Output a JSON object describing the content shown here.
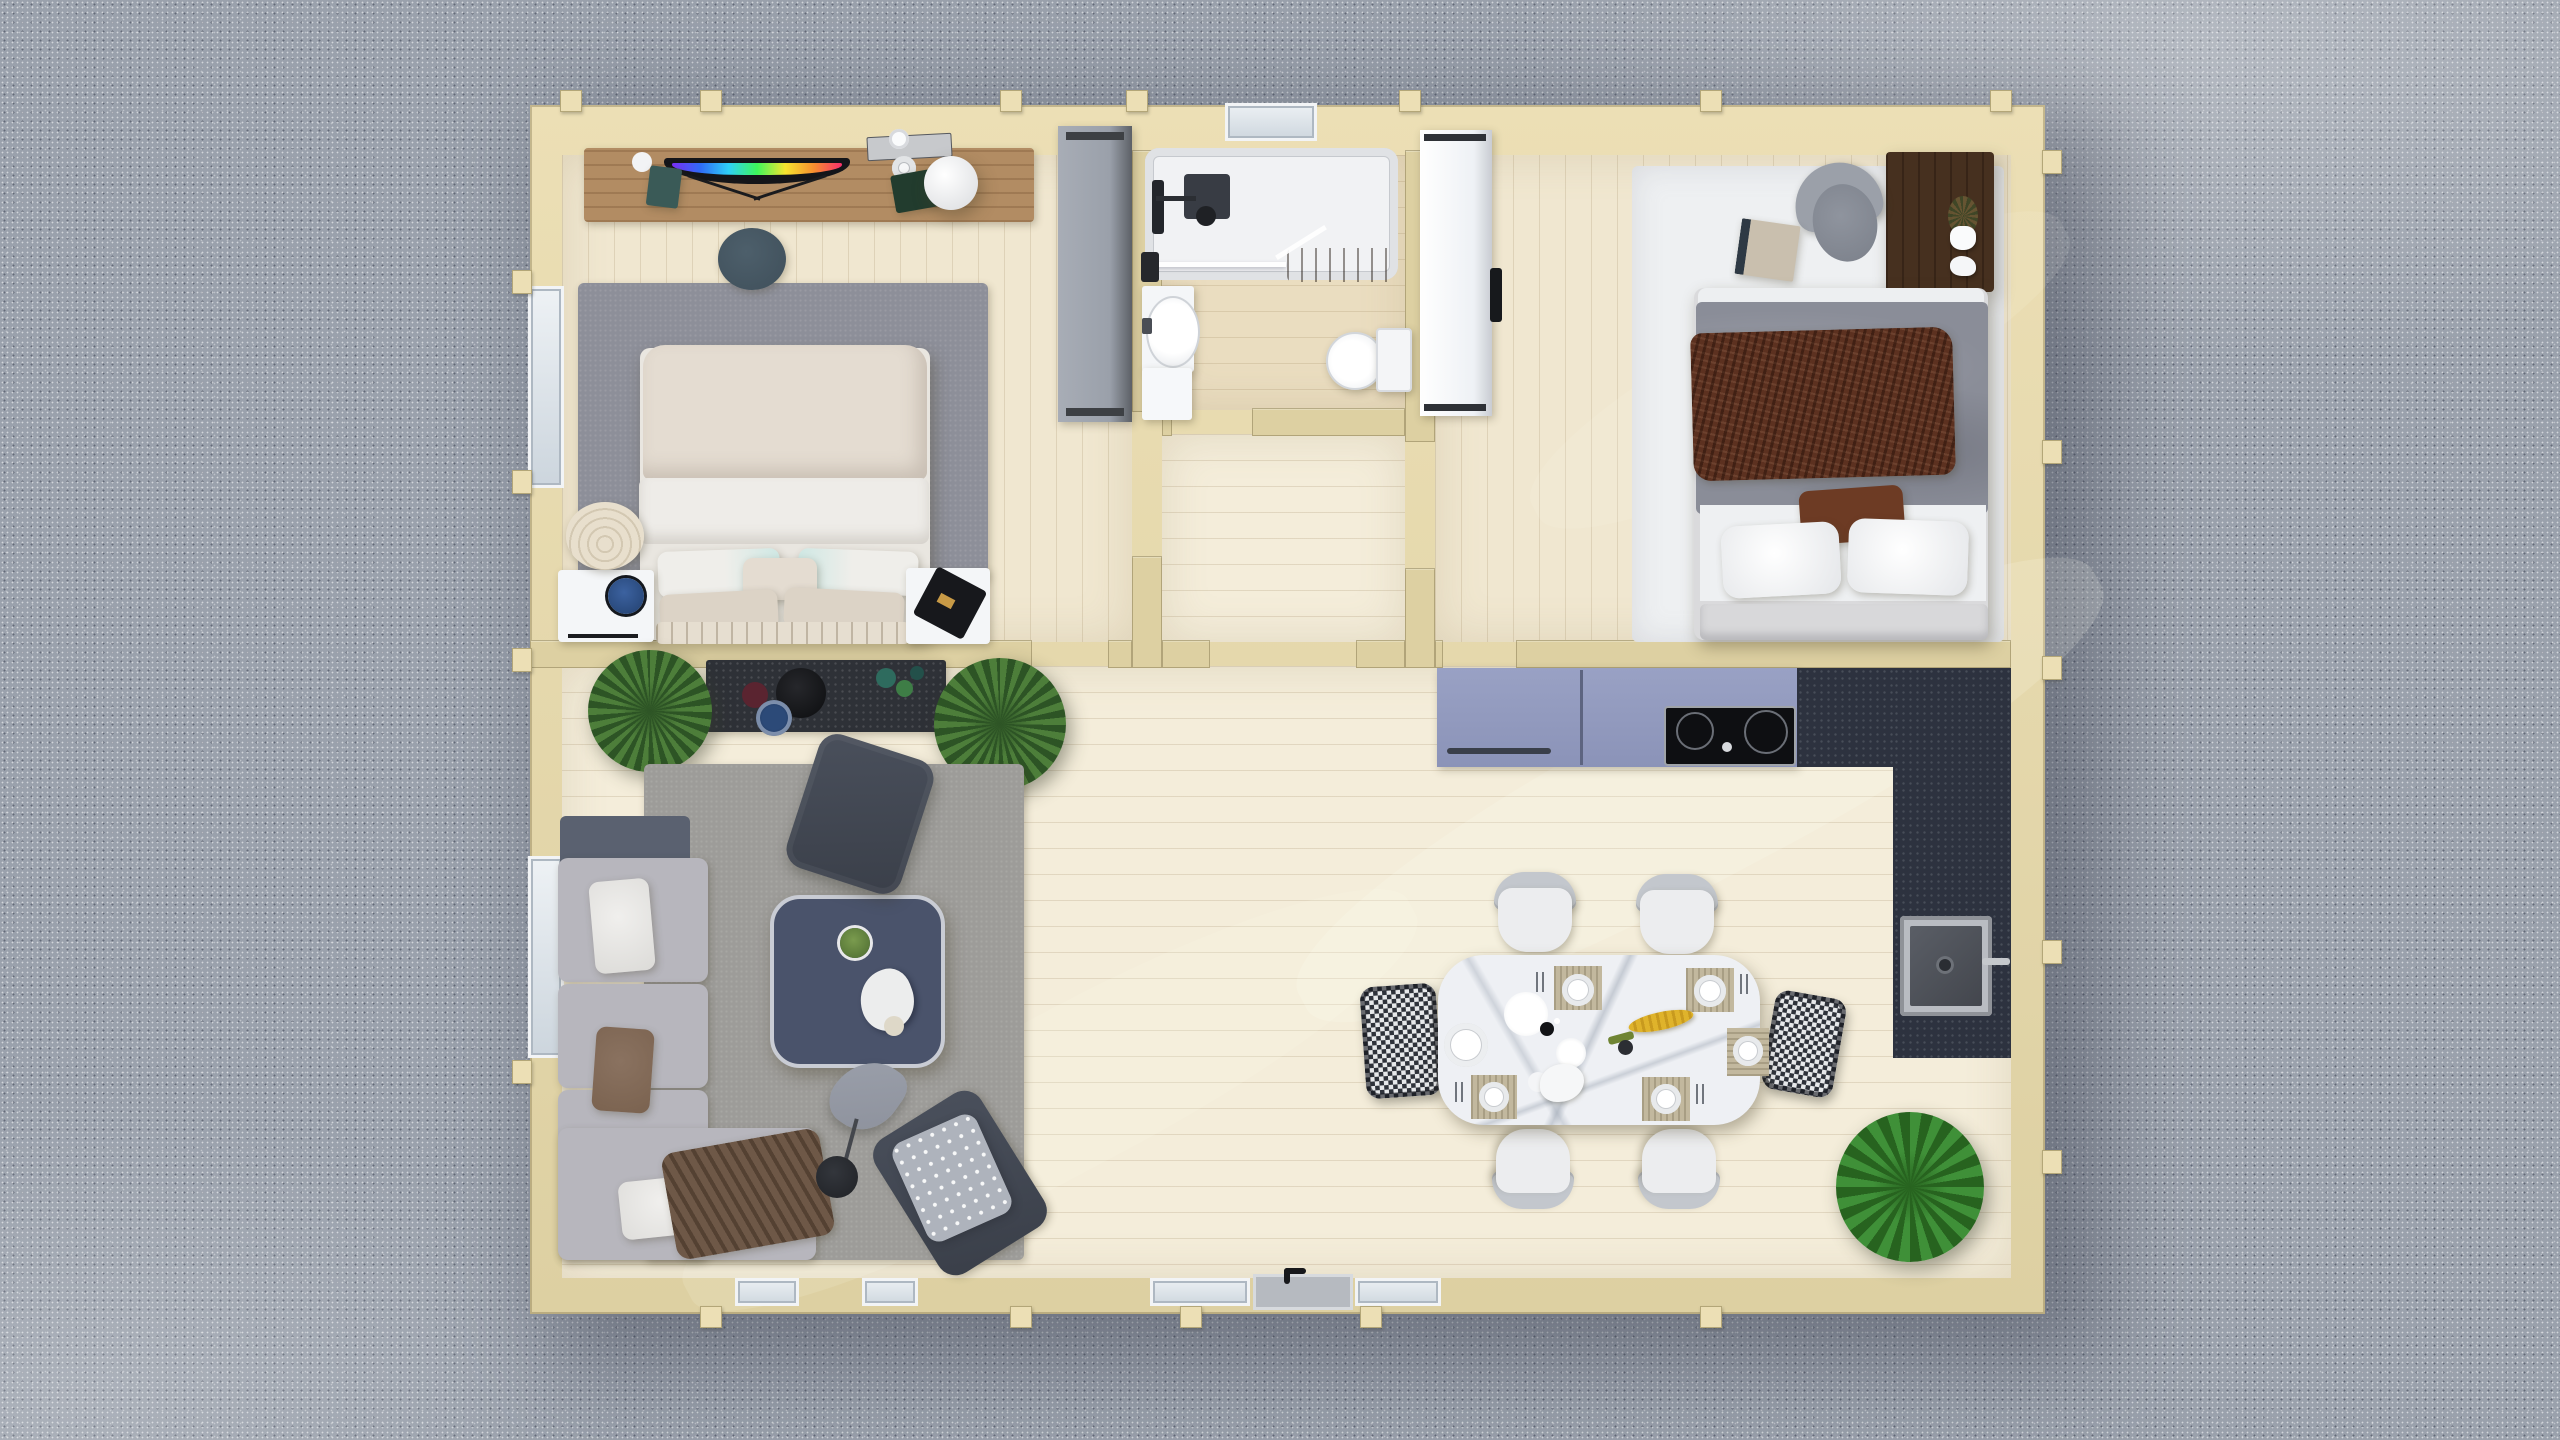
{
  "scene": {
    "type": "top-down 3d architectural render",
    "setting": "single-storey timber cabin floor plan surrounded by gravel ground",
    "rooms": [
      {
        "name": "main-bedroom",
        "contents": [
          "oak media sideboard",
          "curved tv",
          "sphere lamp",
          "tray with papers",
          "green book",
          "teal box",
          "slate pouf",
          "gray area rug",
          "double bed with cream duvet",
          "striped pillows",
          "ribbed ottoman",
          "left nightstand with blue dish",
          "right nightstand with black tray",
          "gray wardrobe"
        ]
      },
      {
        "name": "bathroom",
        "contents": [
          "walk-in shower with glass screen",
          "black shower column",
          "dark shower mat",
          "wood duckboard",
          "washbasin with cabinet",
          "toilet",
          "black towel"
        ]
      },
      {
        "name": "hallway",
        "contents": []
      },
      {
        "name": "second-bedroom",
        "contents": [
          "white wardrobe",
          "white area rug",
          "dark wood desk",
          "desk figurines",
          "office chair",
          "book on rug",
          "double bed with gray duvet",
          "brown knit throw",
          "brown accent pillow",
          "white pillows",
          "upholstered headboard bench"
        ]
      },
      {
        "name": "open-living-area",
        "contents": [
          "blue-gray kitchen run",
          "induction hob",
          "dark stone L-shaped counter",
          "undermount sink",
          "marble dining table",
          "four white dining chairs",
          "two houndstooth end chairs",
          "six place settings",
          "yellow flowers",
          "dark console with bowls",
          "two agave plants",
          "palm plant",
          "gray living rug",
          "l-shaped gray sofa",
          "brown throw blanket",
          "square coffee table",
          "moss bowl",
          "two dark lounge chairs",
          "polka-dot blanket",
          "leaf floor lamp",
          "front door with black handle"
        ]
      }
    ]
  },
  "colors": {
    "gravel": "#9aa1ac",
    "wall": "#ddd0a2",
    "wall-light": "#ecdfb5",
    "wall-edge": "#b3a678",
    "floor-main": "#f4edda",
    "floor-bedroom": "#f0e7d0",
    "floor-bath": "#eaddc0",
    "rug-bedroom": "#8d8f99",
    "rug-living": "#9d9c99",
    "rug-white": "#eef0f2",
    "sofa": "#b7b6bd",
    "sofa-dark": "#5a6170",
    "pillow-brown": "#7a624f",
    "throw-brown": "#6e5847",
    "coffee-table": "#4a536b",
    "chair-dark": "#3a3f49",
    "lamp-shade": "#8d919c",
    "console": "#2e3137",
    "oak": "#b28c63",
    "pouf": "#3f4f5a",
    "bed-cream": "#e4dcd1",
    "bed-white": "#eeece8",
    "duvet-gray": "#8a8d98",
    "blanket-knit": "#5c3120",
    "accent-pillow": "#6d3b24",
    "bench": "#d8d8da",
    "desk": "#46301f",
    "office-chair": "#8a8f99",
    "counter": "#8b93b8",
    "granite": "#2d323f",
    "steel": "#b9bcc2",
    "marble": "#eef0f4",
    "chair-white": "#ecedef",
    "houndstooth-dark": "#2e323a",
    "plant-green": "#4d7e3a",
    "plant-dark": "#2d5425",
    "palm-green": "#3f9038",
    "palm-dark": "#27631f",
    "flower-yellow": "#dfb32b",
    "wardrobe-gray": "#9aa0aa",
    "white-item": "#f4f6f8",
    "shower-mat": "#383c44"
  }
}
